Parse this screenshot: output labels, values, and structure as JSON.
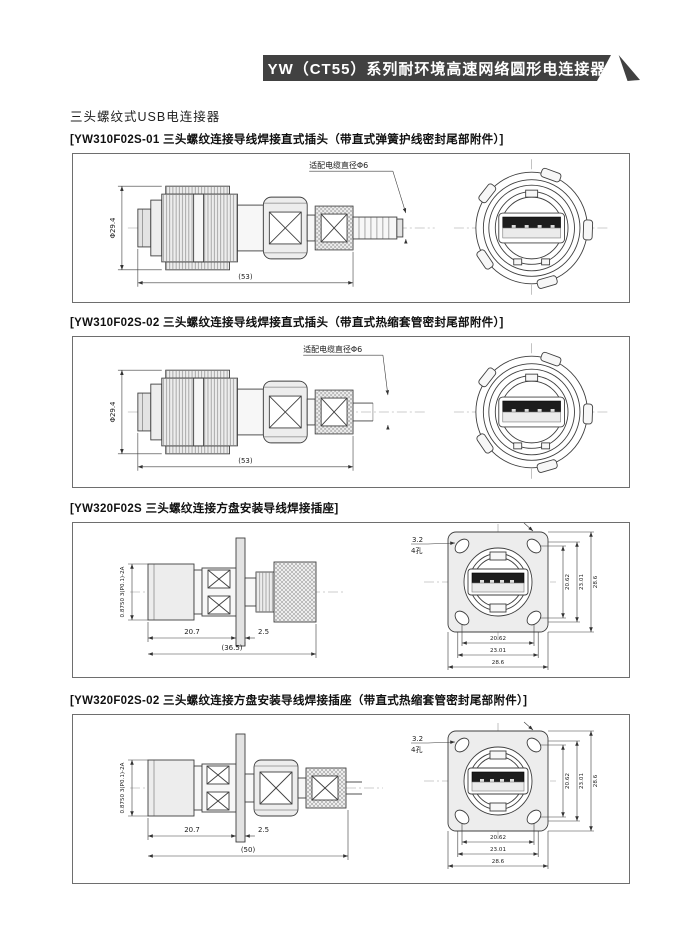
{
  "banner": {
    "title": "YW（CT55）系列耐环境高速网络圆形电连接器",
    "banner_color": "#414141"
  },
  "subtitle": "三头螺纹式USB电连接器",
  "sections": [
    {
      "heading": "[YW310F02S-01 三头螺纹连接导线焊接直式插头（带直式弹簧护线密封尾部附件）]",
      "labels": {
        "diameter": "Φ29.4",
        "overall_length": "(53)",
        "cable_note": "适配电缆直径Φ6"
      }
    },
    {
      "heading": "[YW310F02S-02 三头螺纹连接导线焊接直式插头（带直式热缩套管密封尾部附件）]",
      "labels": {
        "diameter": "Φ29.4",
        "overall_length": "(53)",
        "cable_note": "适配电缆直径Φ6"
      }
    },
    {
      "heading": "[YW320F02S 三头螺纹连接方盘安装导线焊接插座]",
      "labels": {
        "thread": "0.8750 3(P0.1)-2A",
        "front_length": "20.7",
        "flange_thickness": "2.5",
        "overall_length": "(36.5)",
        "hole_diameter": "3.2",
        "hole_count": "4孔",
        "flange_width_dims": [
          "20.62",
          "23.01",
          "28.6"
        ],
        "flange_height_dims": [
          "20.62",
          "23.01",
          "28.6"
        ]
      }
    },
    {
      "heading": "[YW320F02S-02 三头螺纹连接方盘安装导线焊接插座（带直式热缩套管密封尾部附件）]",
      "labels": {
        "thread": "0.8750 3(P0.1)-2A",
        "front_length": "20.7",
        "flange_thickness": "2.5",
        "overall_length": "(50)",
        "hole_diameter": "3.2",
        "hole_count": "4孔",
        "flange_width_dims": [
          "20.62",
          "23.01",
          "28.6"
        ],
        "flange_height_dims": [
          "20.62",
          "23.01",
          "28.6"
        ]
      }
    }
  ]
}
